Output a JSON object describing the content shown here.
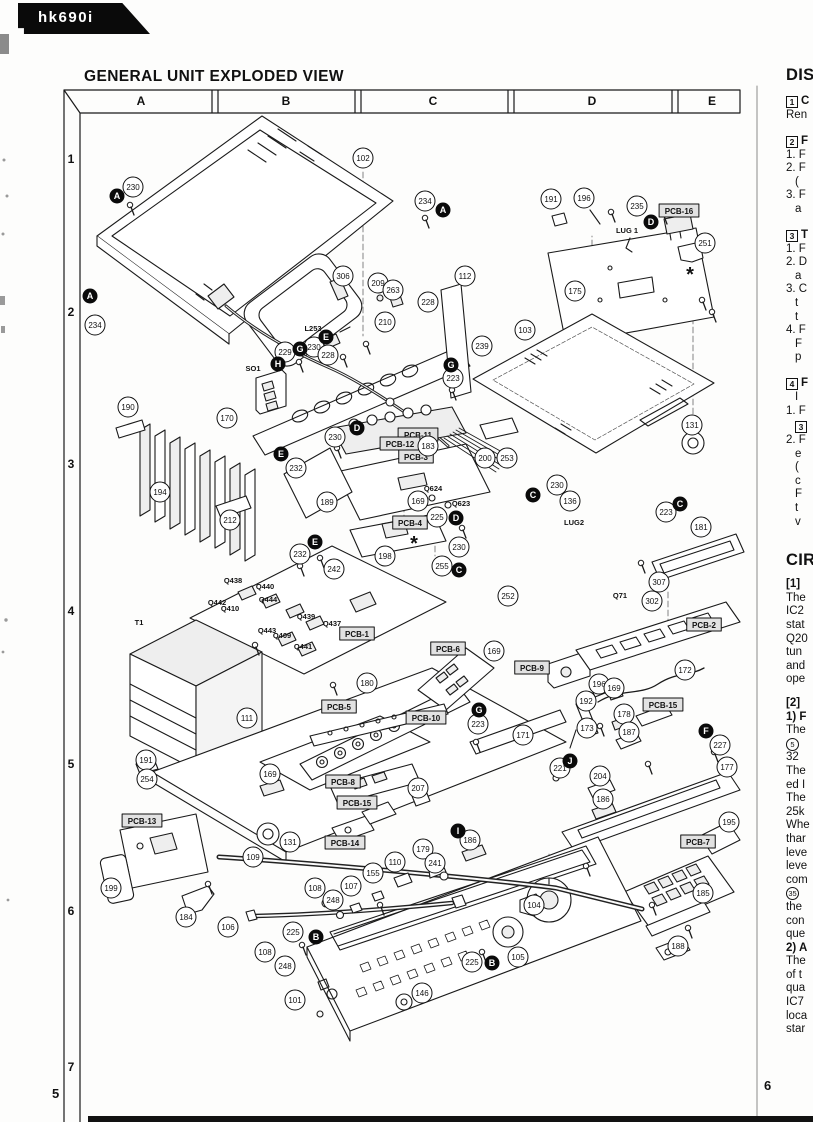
{
  "badge": {
    "label": "hk690i"
  },
  "title": "GENERAL UNIT EXPLODED VIEW",
  "grid": {
    "columns": [
      "A",
      "B",
      "C",
      "D",
      "E"
    ],
    "rows": [
      "1",
      "2",
      "3",
      "4",
      "5",
      "6",
      "7"
    ]
  },
  "pages": {
    "left": "5",
    "right": "6"
  },
  "diagram": {
    "callouts": [
      {
        "n": "102",
        "x": 363,
        "y": 158
      },
      {
        "n": "230",
        "x": 133,
        "y": 187
      },
      {
        "n": "234",
        "x": 425,
        "y": 201
      },
      {
        "n": "191",
        "x": 551,
        "y": 199
      },
      {
        "n": "196",
        "x": 584,
        "y": 198
      },
      {
        "n": "235",
        "x": 637,
        "y": 206
      },
      {
        "n": "251",
        "x": 705,
        "y": 243
      },
      {
        "n": "175",
        "x": 575,
        "y": 291
      },
      {
        "n": "112",
        "x": 465,
        "y": 276
      },
      {
        "n": "306",
        "x": 343,
        "y": 276
      },
      {
        "n": "209",
        "x": 378,
        "y": 283
      },
      {
        "n": "263",
        "x": 393,
        "y": 290
      },
      {
        "n": "228",
        "x": 428,
        "y": 302
      },
      {
        "n": "210",
        "x": 385,
        "y": 322
      },
      {
        "n": "234",
        "x": 95,
        "y": 325
      },
      {
        "n": "229",
        "x": 285,
        "y": 352
      },
      {
        "n": "230",
        "x": 314,
        "y": 347
      },
      {
        "n": "228",
        "x": 328,
        "y": 355
      },
      {
        "n": "103",
        "x": 525,
        "y": 330
      },
      {
        "n": "239",
        "x": 482,
        "y": 346
      },
      {
        "n": "223",
        "x": 453,
        "y": 378
      },
      {
        "n": "190",
        "x": 128,
        "y": 407
      },
      {
        "n": "170",
        "x": 227,
        "y": 418
      },
      {
        "n": "131",
        "x": 692,
        "y": 425
      },
      {
        "n": "230",
        "x": 335,
        "y": 437
      },
      {
        "n": "183",
        "x": 428,
        "y": 446
      },
      {
        "n": "200",
        "x": 485,
        "y": 458
      },
      {
        "n": "253",
        "x": 507,
        "y": 458
      },
      {
        "n": "232",
        "x": 296,
        "y": 468
      },
      {
        "n": "189",
        "x": 327,
        "y": 502
      },
      {
        "n": "169",
        "x": 418,
        "y": 501
      },
      {
        "n": "212",
        "x": 230,
        "y": 520
      },
      {
        "n": "194",
        "x": 160,
        "y": 492
      },
      {
        "n": "225",
        "x": 437,
        "y": 517
      },
      {
        "n": "230",
        "x": 459,
        "y": 547
      },
      {
        "n": "255",
        "x": 442,
        "y": 566
      },
      {
        "n": "230",
        "x": 557,
        "y": 485
      },
      {
        "n": "136",
        "x": 570,
        "y": 501
      },
      {
        "n": "223",
        "x": 666,
        "y": 512
      },
      {
        "n": "181",
        "x": 701,
        "y": 527
      },
      {
        "n": "307",
        "x": 659,
        "y": 582
      },
      {
        "n": "302",
        "x": 652,
        "y": 601
      },
      {
        "n": "252",
        "x": 508,
        "y": 596
      },
      {
        "n": "242",
        "x": 334,
        "y": 569
      },
      {
        "n": "198",
        "x": 385,
        "y": 556
      },
      {
        "n": "232",
        "x": 300,
        "y": 554
      },
      {
        "n": "180",
        "x": 367,
        "y": 683
      },
      {
        "n": "169",
        "x": 494,
        "y": 651
      },
      {
        "n": "196",
        "x": 599,
        "y": 684
      },
      {
        "n": "169",
        "x": 614,
        "y": 688
      },
      {
        "n": "192",
        "x": 586,
        "y": 701
      },
      {
        "n": "178",
        "x": 624,
        "y": 714
      },
      {
        "n": "173",
        "x": 587,
        "y": 728
      },
      {
        "n": "187",
        "x": 629,
        "y": 732
      },
      {
        "n": "227",
        "x": 720,
        "y": 745
      },
      {
        "n": "177",
        "x": 727,
        "y": 767
      },
      {
        "n": "172",
        "x": 685,
        "y": 670
      },
      {
        "n": "171",
        "x": 523,
        "y": 735
      },
      {
        "n": "223",
        "x": 478,
        "y": 724
      },
      {
        "n": "207",
        "x": 418,
        "y": 788
      },
      {
        "n": "191",
        "x": 146,
        "y": 760
      },
      {
        "n": "254",
        "x": 147,
        "y": 779
      },
      {
        "n": "169",
        "x": 270,
        "y": 774
      },
      {
        "n": "111",
        "x": 247,
        "y": 718
      },
      {
        "n": "199",
        "x": 111,
        "y": 888
      },
      {
        "n": "184",
        "x": 186,
        "y": 917
      },
      {
        "n": "106",
        "x": 228,
        "y": 927
      },
      {
        "n": "109",
        "x": 253,
        "y": 857
      },
      {
        "n": "131",
        "x": 290,
        "y": 842
      },
      {
        "n": "108",
        "x": 315,
        "y": 888
      },
      {
        "n": "248",
        "x": 333,
        "y": 900
      },
      {
        "n": "179",
        "x": 423,
        "y": 849
      },
      {
        "n": "241",
        "x": 435,
        "y": 863
      },
      {
        "n": "186",
        "x": 470,
        "y": 840
      },
      {
        "n": "110",
        "x": 395,
        "y": 862
      },
      {
        "n": "155",
        "x": 373,
        "y": 873
      },
      {
        "n": "107",
        "x": 351,
        "y": 886
      },
      {
        "n": "204",
        "x": 600,
        "y": 776
      },
      {
        "n": "186",
        "x": 603,
        "y": 799
      },
      {
        "n": "221",
        "x": 560,
        "y": 768
      },
      {
        "n": "195",
        "x": 729,
        "y": 822
      },
      {
        "n": "185",
        "x": 703,
        "y": 893
      },
      {
        "n": "188",
        "x": 678,
        "y": 946
      },
      {
        "n": "104",
        "x": 534,
        "y": 905
      },
      {
        "n": "225",
        "x": 293,
        "y": 932
      },
      {
        "n": "108",
        "x": 265,
        "y": 952
      },
      {
        "n": "248",
        "x": 285,
        "y": 966
      },
      {
        "n": "225",
        "x": 472,
        "y": 962
      },
      {
        "n": "105",
        "x": 518,
        "y": 957
      },
      {
        "n": "146",
        "x": 422,
        "y": 993
      },
      {
        "n": "101",
        "x": 295,
        "y": 1000
      }
    ],
    "markers": [
      {
        "l": "A",
        "x": 117,
        "y": 196
      },
      {
        "l": "A",
        "x": 443,
        "y": 210
      },
      {
        "l": "A",
        "x": 90,
        "y": 296
      },
      {
        "l": "B",
        "x": 316,
        "y": 937
      },
      {
        "l": "B",
        "x": 492,
        "y": 963
      },
      {
        "l": "C",
        "x": 533,
        "y": 495
      },
      {
        "l": "C",
        "x": 459,
        "y": 570
      },
      {
        "l": "C",
        "x": 680,
        "y": 504
      },
      {
        "l": "D",
        "x": 651,
        "y": 222
      },
      {
        "l": "D",
        "x": 357,
        "y": 428
      },
      {
        "l": "D",
        "x": 456,
        "y": 518
      },
      {
        "l": "E",
        "x": 326,
        "y": 337
      },
      {
        "l": "E",
        "x": 281,
        "y": 454
      },
      {
        "l": "E",
        "x": 315,
        "y": 542
      },
      {
        "l": "F",
        "x": 706,
        "y": 731
      },
      {
        "l": "G",
        "x": 300,
        "y": 349
      },
      {
        "l": "G",
        "x": 451,
        "y": 365
      },
      {
        "l": "G",
        "x": 479,
        "y": 710
      },
      {
        "l": "H",
        "x": 278,
        "y": 364
      },
      {
        "l": "I",
        "x": 458,
        "y": 831
      },
      {
        "l": "J",
        "x": 570,
        "y": 761
      }
    ],
    "boxed_labels": [
      {
        "t": "PCB-16",
        "x": 679,
        "y": 211
      },
      {
        "t": "PCB-11",
        "x": 418,
        "y": 435
      },
      {
        "t": "PCB-12",
        "x": 400,
        "y": 444
      },
      {
        "t": "PCB-3",
        "x": 416,
        "y": 457
      },
      {
        "t": "PCB-4",
        "x": 410,
        "y": 523
      },
      {
        "t": "PCB-1",
        "x": 357,
        "y": 634
      },
      {
        "t": "PCB-2",
        "x": 704,
        "y": 625
      },
      {
        "t": "PCB-5",
        "x": 339,
        "y": 707
      },
      {
        "t": "PCB-6",
        "x": 448,
        "y": 649
      },
      {
        "t": "PCB-9",
        "x": 532,
        "y": 668
      },
      {
        "t": "PCB-10",
        "x": 426,
        "y": 718
      },
      {
        "t": "PCB-15",
        "x": 663,
        "y": 705
      },
      {
        "t": "PCB-15",
        "x": 357,
        "y": 803
      },
      {
        "t": "PCB-8",
        "x": 343,
        "y": 782
      },
      {
        "t": "PCB-13",
        "x": 142,
        "y": 821
      },
      {
        "t": "PCB-14",
        "x": 345,
        "y": 843
      },
      {
        "t": "PCB-7",
        "x": 698,
        "y": 842
      }
    ],
    "text_labels": [
      {
        "t": "LUG 1",
        "x": 627,
        "y": 233
      },
      {
        "t": "LUG2",
        "x": 574,
        "y": 525
      },
      {
        "t": "L253",
        "x": 313,
        "y": 331
      },
      {
        "t": "SO1",
        "x": 253,
        "y": 371
      },
      {
        "t": "T1",
        "x": 139,
        "y": 625
      },
      {
        "t": "Q71",
        "x": 620,
        "y": 598
      },
      {
        "t": "Q624",
        "x": 433,
        "y": 491
      },
      {
        "t": "Q623",
        "x": 461,
        "y": 506
      },
      {
        "t": "Q438",
        "x": 233,
        "y": 583
      },
      {
        "t": "Q440",
        "x": 265,
        "y": 589
      },
      {
        "t": "Q442",
        "x": 217,
        "y": 605
      },
      {
        "t": "Q444",
        "x": 268,
        "y": 602
      },
      {
        "t": "Q410",
        "x": 230,
        "y": 611
      },
      {
        "t": "Q439",
        "x": 306,
        "y": 619
      },
      {
        "t": "Q437",
        "x": 332,
        "y": 626
      },
      {
        "t": "Q443",
        "x": 267,
        "y": 633
      },
      {
        "t": "Q409",
        "x": 282,
        "y": 638
      },
      {
        "t": "Q441",
        "x": 303,
        "y": 649
      }
    ],
    "asterisks": [
      {
        "x": 690,
        "y": 281
      },
      {
        "x": 414,
        "y": 550
      }
    ],
    "screws": [
      {
        "x": 130,
        "y": 205
      },
      {
        "x": 425,
        "y": 218
      },
      {
        "x": 299,
        "y": 362
      },
      {
        "x": 343,
        "y": 357
      },
      {
        "x": 366,
        "y": 344
      },
      {
        "x": 611,
        "y": 212
      },
      {
        "x": 663,
        "y": 214
      },
      {
        "x": 702,
        "y": 300
      },
      {
        "x": 712,
        "y": 312
      },
      {
        "x": 337,
        "y": 448
      },
      {
        "x": 452,
        "y": 390
      },
      {
        "x": 462,
        "y": 528
      },
      {
        "x": 300,
        "y": 566
      },
      {
        "x": 320,
        "y": 558
      },
      {
        "x": 641,
        "y": 563
      },
      {
        "x": 255,
        "y": 645
      },
      {
        "x": 333,
        "y": 685
      },
      {
        "x": 476,
        "y": 742
      },
      {
        "x": 600,
        "y": 726
      },
      {
        "x": 648,
        "y": 764
      },
      {
        "x": 714,
        "y": 752
      },
      {
        "x": 380,
        "y": 905
      },
      {
        "x": 302,
        "y": 945
      },
      {
        "x": 482,
        "y": 952
      },
      {
        "x": 652,
        "y": 905
      },
      {
        "x": 688,
        "y": 928
      },
      {
        "x": 208,
        "y": 884
      },
      {
        "x": 586,
        "y": 866
      }
    ]
  },
  "right_column": {
    "lines": [
      {
        "style": "h1",
        "text": "DIS"
      },
      {
        "style": "boxline",
        "box": "1",
        "text": "C"
      },
      {
        "style": "n",
        "text": "Ren"
      },
      {
        "style": "gap"
      },
      {
        "style": "boxline",
        "box": "2",
        "text": "F"
      },
      {
        "style": "n",
        "text": "1. F"
      },
      {
        "style": "n",
        "text": "2. F"
      },
      {
        "style": "ind",
        "text": "("
      },
      {
        "style": "n",
        "text": "3. F"
      },
      {
        "style": "ind",
        "text": "a"
      },
      {
        "style": "gap"
      },
      {
        "style": "boxline",
        "box": "3",
        "text": "T"
      },
      {
        "style": "n",
        "text": "1. F"
      },
      {
        "style": "n",
        "text": "2. D"
      },
      {
        "style": "ind",
        "text": "a"
      },
      {
        "style": "n",
        "text": "3. C"
      },
      {
        "style": "ind",
        "text": "t"
      },
      {
        "style": "ind",
        "text": "t"
      },
      {
        "style": "n",
        "text": "4. F"
      },
      {
        "style": "ind",
        "text": "F"
      },
      {
        "style": "ind",
        "text": "p"
      },
      {
        "style": "gap"
      },
      {
        "style": "boxline",
        "box": "4",
        "text": "F"
      },
      {
        "style": "ind",
        "text": "I"
      },
      {
        "style": "n",
        "text": "1. F"
      },
      {
        "style": "indbox",
        "box": "3",
        "text": ""
      },
      {
        "style": "n",
        "text": "2. F"
      },
      {
        "style": "ind",
        "text": "e"
      },
      {
        "style": "ind",
        "text": "("
      },
      {
        "style": "ind",
        "text": "c"
      },
      {
        "style": "ind",
        "text": "F"
      },
      {
        "style": "ind",
        "text": "t"
      },
      {
        "style": "ind",
        "text": "v"
      },
      {
        "style": "gap2"
      },
      {
        "style": "h1",
        "text": "CIR"
      },
      {
        "style": "b",
        "text": "[1]"
      },
      {
        "style": "n",
        "text": "The"
      },
      {
        "style": "n",
        "text": "IC2"
      },
      {
        "style": "n",
        "text": "stat"
      },
      {
        "style": "n",
        "text": "Q20"
      },
      {
        "style": "n",
        "text": "tun"
      },
      {
        "style": "n",
        "text": "and"
      },
      {
        "style": "n",
        "text": "ope"
      },
      {
        "style": "gap"
      },
      {
        "style": "b",
        "text": "[2]"
      },
      {
        "style": "b",
        "text": "1) F"
      },
      {
        "style": "n",
        "text": "The"
      },
      {
        "style": "circline",
        "circ": "5",
        "text": ""
      },
      {
        "style": "n",
        "text": "32"
      },
      {
        "style": "n",
        "text": "The"
      },
      {
        "style": "n",
        "text": "ed I"
      },
      {
        "style": "n",
        "text": "The"
      },
      {
        "style": "n",
        "text": "25k"
      },
      {
        "style": "n",
        "text": "Whe"
      },
      {
        "style": "n",
        "text": "thar"
      },
      {
        "style": "n",
        "text": "leve"
      },
      {
        "style": "n",
        "text": "leve"
      },
      {
        "style": "n",
        "text": "com"
      },
      {
        "style": "circline",
        "circ": "35",
        "text": ""
      },
      {
        "style": "n",
        "text": "the"
      },
      {
        "style": "n",
        "text": "con"
      },
      {
        "style": "n",
        "text": "que"
      },
      {
        "style": "b",
        "text": "2) A"
      },
      {
        "style": "n",
        "text": "The"
      },
      {
        "style": "n",
        "text": "of t"
      },
      {
        "style": "n",
        "text": "qua"
      },
      {
        "style": "n",
        "text": "IC7"
      },
      {
        "style": "n",
        "text": "loca"
      },
      {
        "style": "n",
        "text": "star"
      }
    ]
  }
}
